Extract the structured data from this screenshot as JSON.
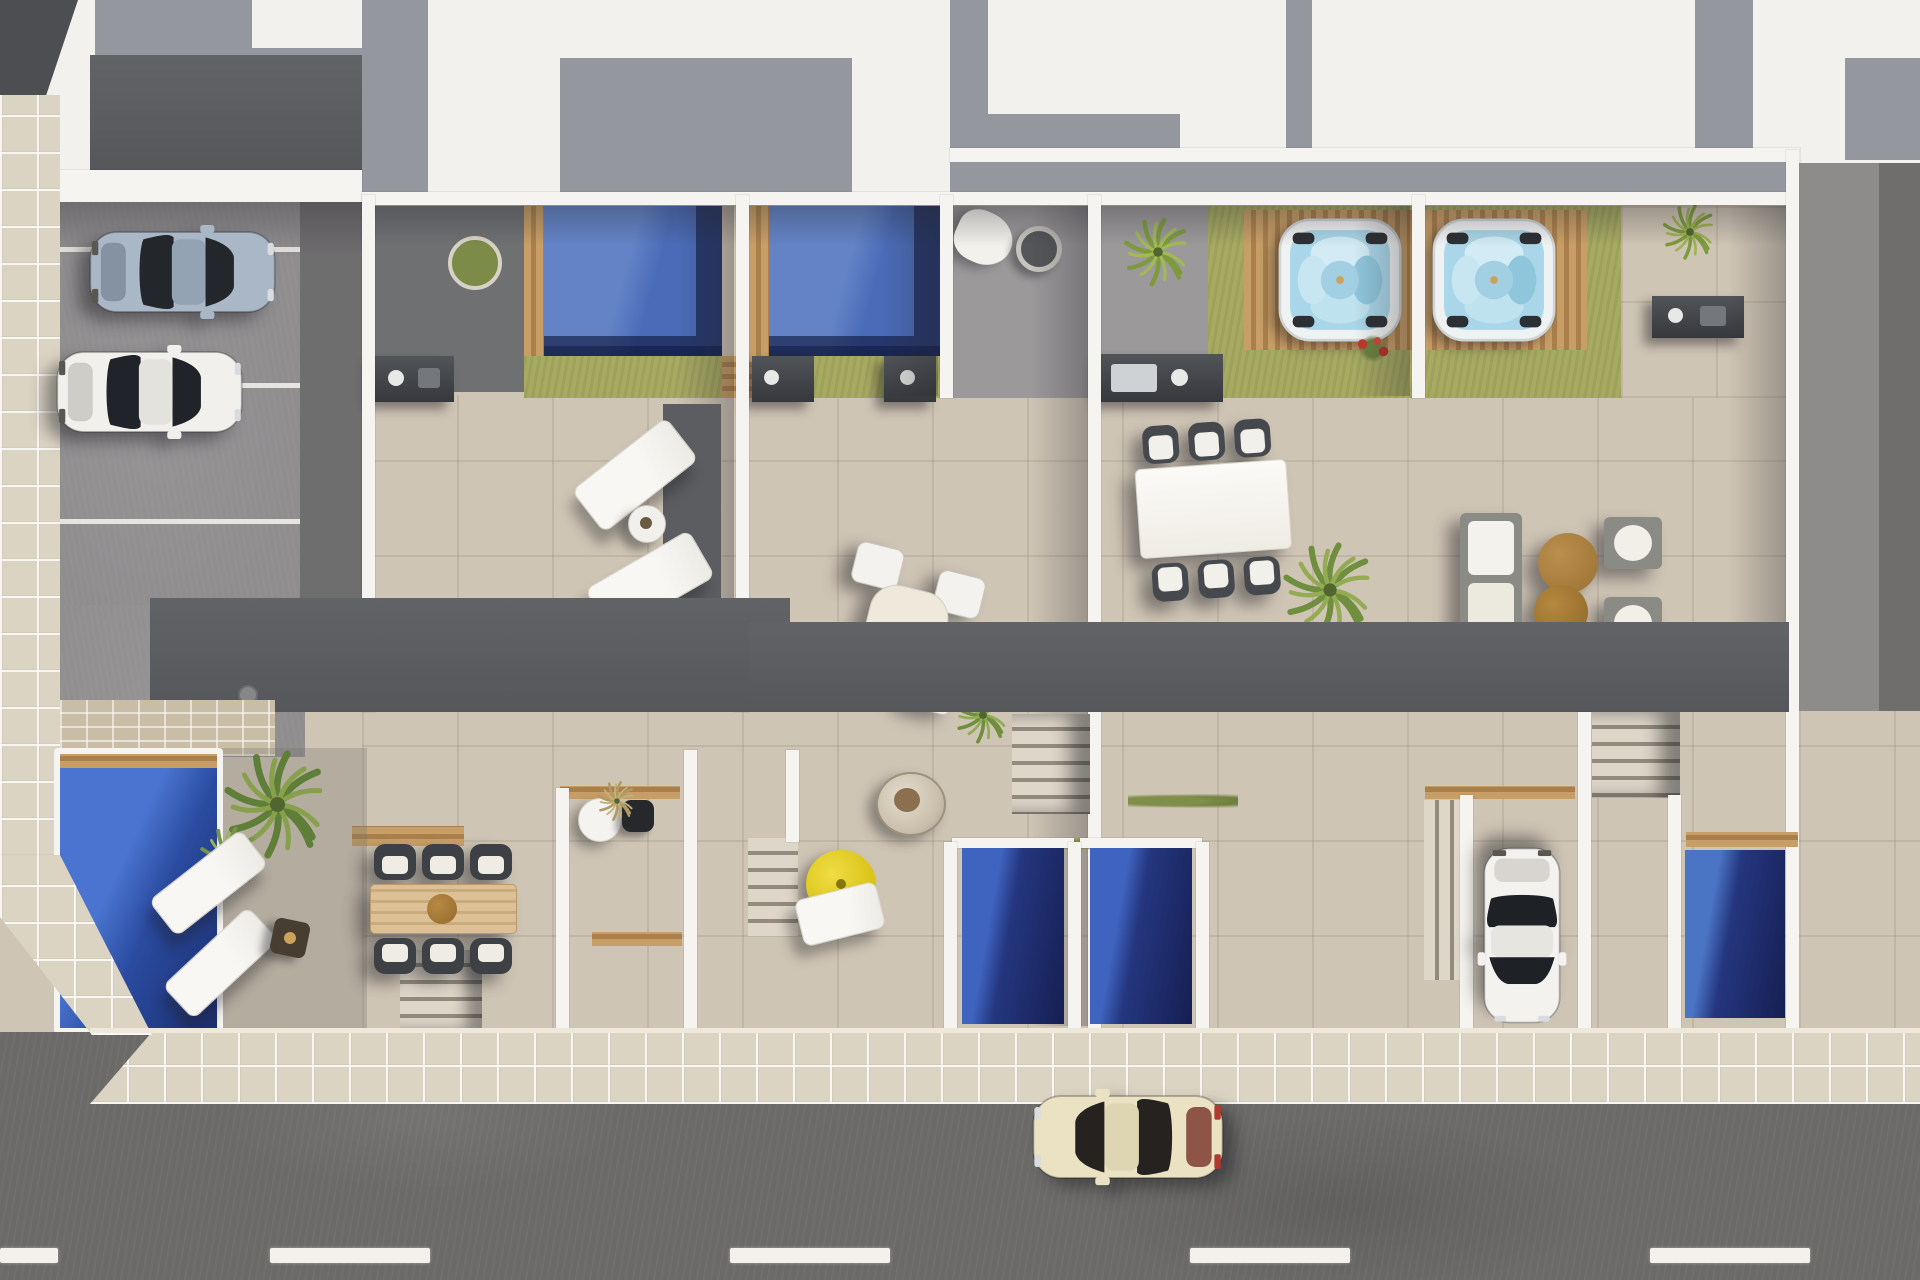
{
  "scene": {
    "title": "Aerial 3D render of a row of four townhouses with roof terraces, pools and street",
    "view": "top-down bird's-eye",
    "palette": {
      "terrace": "#cfc5b5",
      "terrace_light": "#d8cfc0",
      "wall": "#f6f4f0",
      "roof_white": "#f3f1ed",
      "roof_shadow": "#94979e",
      "roof_dark": "#4c4e52",
      "deck_dark": "#5a5c60",
      "patio_gray": "#9b999a",
      "service_gray": "#6e7072",
      "parking": "#8f8d8e",
      "asphalt": "#6b6a68",
      "sidewalk": "#dcd4c3",
      "lawn": "#a7ab62",
      "lawn_shadow": "#7d8246",
      "wood": "#c0955e",
      "pool_blue": "#4a6cb8",
      "pool_dark": "#1c2f66",
      "pool_bright": "#3f6acc",
      "spa_water": "#a9d6e8",
      "parasol_yellow": "#e6cf1e",
      "table_brown": "#a97d3c",
      "car_silver_blue": "#a9b7c6",
      "car_white": "#f1f0ed",
      "car_cream": "#eae2c2"
    },
    "street": {
      "label": "asphalt street with dashed white lane marking",
      "lane_dashes": 4
    },
    "sidewalk": {
      "label": "cream tiled sidewalk wrapping the corner"
    },
    "parking": {
      "label": "open-air parking bays beside the building",
      "stall_lines": 3,
      "cars": [
        {
          "id": "car-parked-silver-blue",
          "label": "silver-blue coupe parked in bay"
        },
        {
          "id": "car-parked-white",
          "label": "white car parked in bay"
        }
      ]
    },
    "roof_terraces": [
      {
        "id": "unit-a",
        "label": "roof terrace A",
        "features": [
          "plunge pool with timber deck",
          "lawn strip",
          "outdoor kitchen",
          "two sun loungers",
          "round side table",
          "service patio with planter"
        ]
      },
      {
        "id": "unit-b",
        "label": "roof terrace B",
        "features": [
          "plunge pool with timber deck",
          "lawn strip",
          "white parasol",
          "fire pit",
          "round dining table with four chairs",
          "palm"
        ]
      },
      {
        "id": "unit-c",
        "label": "roof terrace C",
        "features": [
          "hot tub on timber deck",
          "lawn",
          "outdoor kitchen",
          "rectangular dining table with six chairs",
          "palm"
        ]
      },
      {
        "id": "unit-d",
        "label": "roof terrace D",
        "features": [
          "hot tub on timber deck",
          "lawn",
          "flower bush",
          "sofa with two armchairs",
          "two round brown coffee tables",
          "palm"
        ]
      }
    ],
    "ground_level": {
      "label": "ground-floor patios",
      "features": [
        "large blue pool with timber edge",
        "two angled white loungers",
        "dark side table",
        "timber dining table with six wicker chairs",
        "white bistro table with black chair",
        "yellow parasol with lounger",
        "hanging egg chair",
        "three narrow plunge pools",
        "white car on private driveway",
        "staircases"
      ]
    },
    "street_cars": [
      {
        "id": "car-street-cream",
        "label": "cream classic coupe driving on street"
      }
    ],
    "pools_count": {
      "roof_plunge_pools": 2,
      "hot_tubs": 2,
      "ground_pools": 4
    }
  }
}
